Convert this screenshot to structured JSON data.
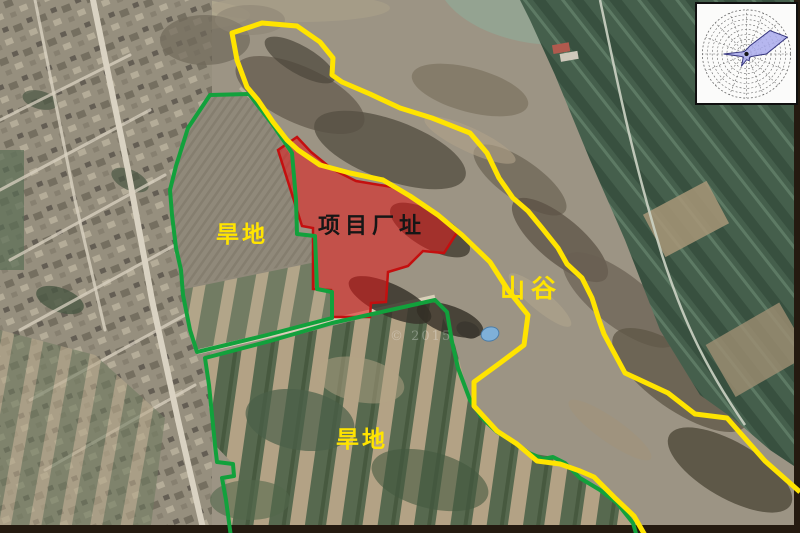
{
  "map": {
    "labels": {
      "project_site": "项目厂址",
      "dryland_upper": "旱地",
      "dryland_lower": "旱地",
      "valley": "山谷"
    },
    "watermark": "© 2015",
    "colors": {
      "site_fill": "#e41a1c",
      "site_border": "#c40f0f",
      "parcel_boundary_green": "#12a13c",
      "valley_boundary_yellow": "#ffe400",
      "label_yellow": "#ffe400",
      "label_dark": "#161616"
    }
  },
  "wind_rose": {
    "name": "wind-rose-inset",
    "directions": [
      "N",
      "NNE",
      "NE",
      "ENE",
      "E",
      "ESE",
      "SE",
      "SSE",
      "S",
      "SSW",
      "SW",
      "WSW",
      "W",
      "WNW",
      "NW",
      "NNW"
    ],
    "values": [
      0.1,
      0.2,
      0.75,
      1.0,
      0.45,
      0.14,
      0.1,
      0.16,
      0.13,
      0.3,
      0.1,
      0.14,
      0.52,
      0.12,
      0.08,
      0.08
    ],
    "rings": 9,
    "fill": "#a9aaec",
    "stroke": "#34347e"
  }
}
